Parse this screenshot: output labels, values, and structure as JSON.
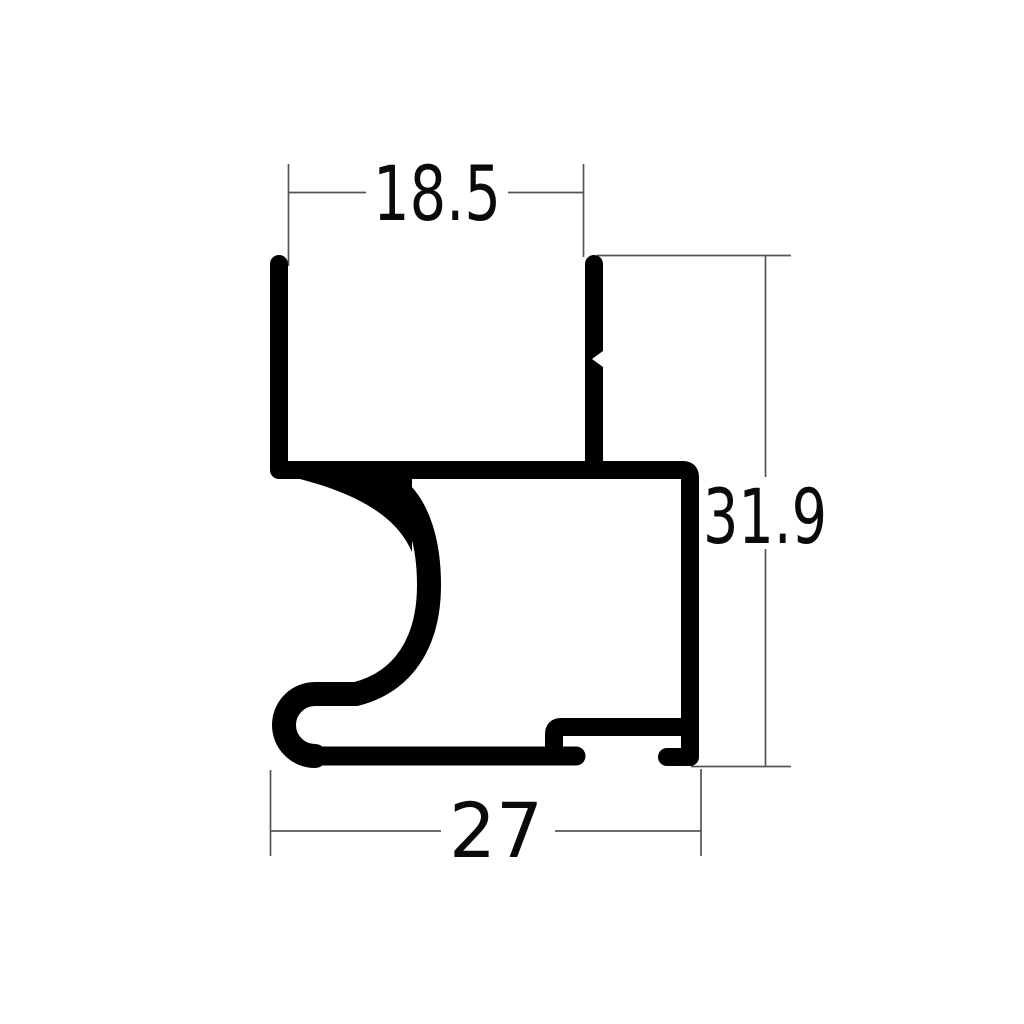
{
  "drawing": {
    "kind": "extrusion-profile-cross-section",
    "dimensions": {
      "top_width": "18.5",
      "height": "31.9",
      "bottom_width": "27"
    }
  },
  "colors": {
    "background": "#ffffff",
    "profile": "#000000",
    "dim_line": "#555555",
    "dim_text": "#0a0a0a"
  }
}
